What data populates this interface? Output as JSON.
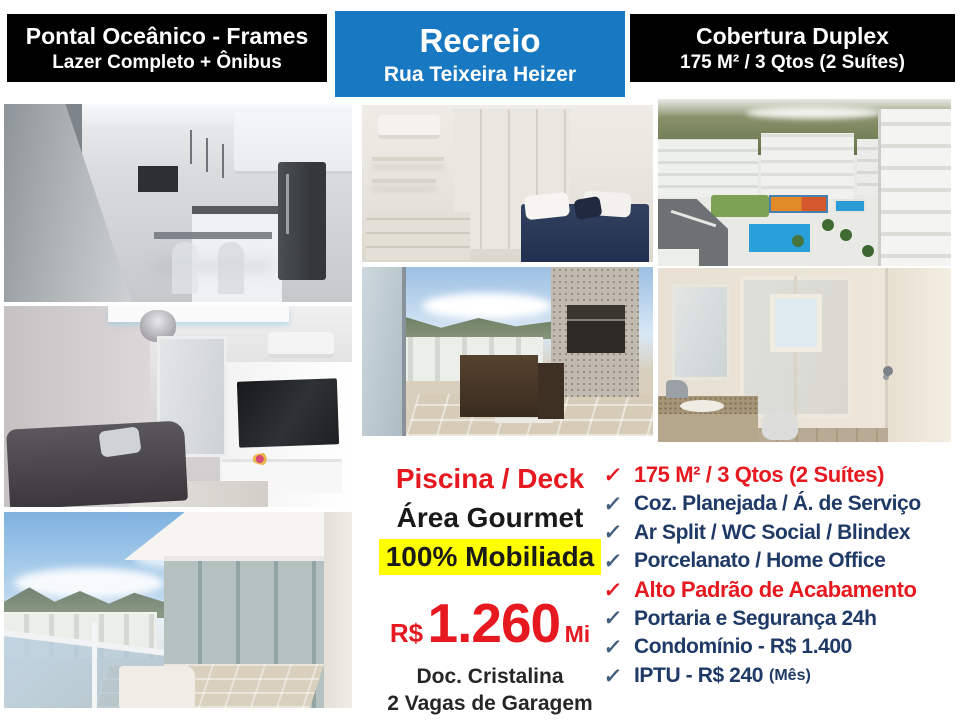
{
  "header": {
    "left": {
      "line1": "Pontal Oceânico - Frames",
      "line2": "Lazer Completo + Ônibus"
    },
    "center": {
      "line1": "Recreio",
      "line2": "Rua Teixeira Heizer"
    },
    "right": {
      "line1": "Cobertura Duplex",
      "line2": "175 M²  / 3 Qtos (2 Suítes)"
    }
  },
  "pricing": {
    "feature_pool": "Piscina / Deck",
    "feature_gourmet": "Área Gourmet",
    "feature_furnished": "100% Mobiliada",
    "currency": "R$",
    "amount": "1.260",
    "unit": "Mi",
    "doc": "Doc. Cristalina",
    "parking": "2 Vagas de Garagem"
  },
  "checklist": {
    "check_glyph": "✓",
    "items": [
      {
        "text": "175 M² / 3 Qtos (2 Suítes)",
        "emphasis": "red"
      },
      {
        "text": "Coz. Planejada / Á. de Serviço",
        "emphasis": "blue"
      },
      {
        "text": "Ar Split / WC Social /  Blindex",
        "emphasis": "blue"
      },
      {
        "text": "Porcelanato / Home Office",
        "emphasis": "blue"
      },
      {
        "text": "Alto Padrão de Acabamento",
        "emphasis": "red"
      },
      {
        "text": "Portaria e Segurança 24h",
        "emphasis": "blue"
      },
      {
        "text": "Condomínio - R$ 1.400",
        "emphasis": "blue"
      },
      {
        "text": "IPTU - R$ 240",
        "suffix": "(Mês)",
        "emphasis": "blue"
      }
    ]
  },
  "palette": {
    "header_blue": "#1878c2",
    "header_black": "#000000",
    "accent_red": "#e5191f",
    "text_dark_blue": "#1f3a66",
    "highlight_yellow": "#ffff00"
  }
}
